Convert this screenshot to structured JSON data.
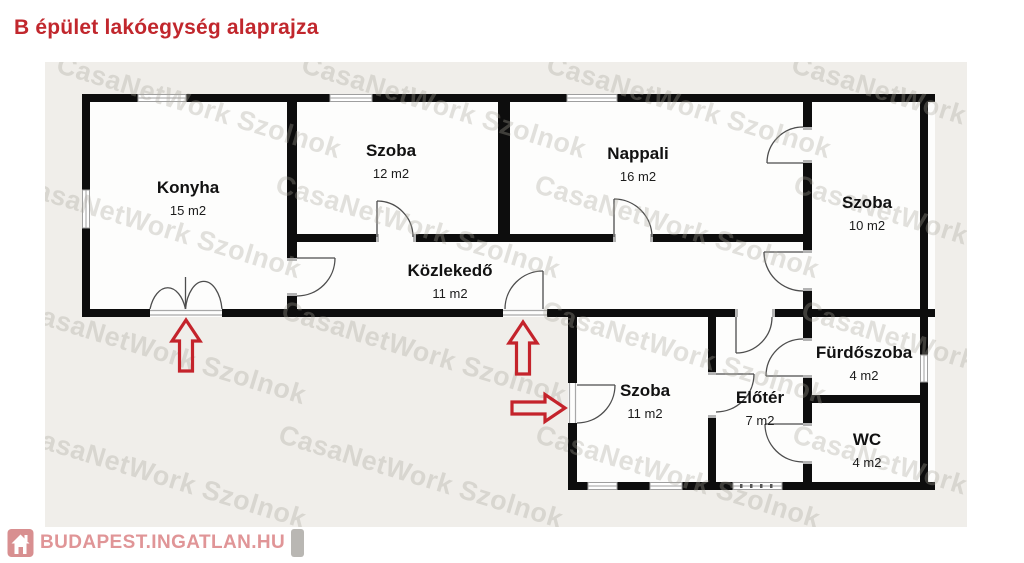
{
  "title": "B épület lakóegység alaprajza",
  "watermark": {
    "text": "CasaNetWork Szolnok"
  },
  "branding": {
    "logo_text": "BUDAPEST.INGATLAN.HU"
  },
  "rooms": [
    {
      "id": "konyha",
      "name": "Konyha",
      "area": "15 m2"
    },
    {
      "id": "szoba12",
      "name": "Szoba",
      "area": "12 m2"
    },
    {
      "id": "nappali",
      "name": "Nappali",
      "area": "16 m2"
    },
    {
      "id": "szoba10",
      "name": "Szoba",
      "area": "10 m2"
    },
    {
      "id": "kozlekedo",
      "name": "Közlekedő",
      "area": "11 m2"
    },
    {
      "id": "szoba11",
      "name": "Szoba",
      "area": "11 m2"
    },
    {
      "id": "eloter",
      "name": "Előtér",
      "area": "7 m2"
    },
    {
      "id": "furdoszoba",
      "name": "Fürdőszoba",
      "area": "4 m2"
    },
    {
      "id": "wc",
      "name": "WC",
      "area": "4 m2"
    }
  ],
  "entrance_arrows": [
    {
      "direction": "up",
      "at": "konyha-entrance"
    },
    {
      "direction": "up",
      "at": "kozlekedo-entrance"
    },
    {
      "direction": "right",
      "at": "szoba11-entrance"
    }
  ],
  "colors": {
    "title_red": "#c1272d",
    "arrow_red": "#c4232b",
    "logo_pink": "#e09597",
    "canvas_bg": "#f0eeea",
    "wall_black": "#0d0d0d",
    "watermark_gray": "#a8a59a"
  }
}
